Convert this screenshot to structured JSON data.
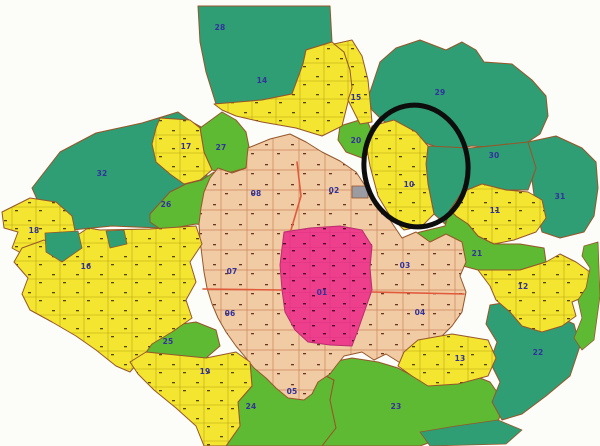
{
  "map": {
    "background": "#fcfcf9",
    "label_color": "#32329b",
    "road_color": "#e05a3c",
    "borders": {
      "default": "#96562a",
      "magenta": "#b72f6e"
    },
    "colors": {
      "teal": "#2f9e74",
      "green": "#5fba33",
      "yellow": "#f4e630",
      "salmon": "#f1cba4",
      "magenta": "#ee3f8d",
      "grey": "#9b9ba2",
      "salmon_line": "#c97d53",
      "yellow_line": "#b0960f",
      "magenta_line": "#d62f7c",
      "mark_salmon": "#6b3522",
      "mark_yellow": "#564508",
      "mark_magenta": "#55082e"
    },
    "annotation_circle": {
      "cx": 416,
      "cy": 166,
      "rx": 52,
      "ry": 61,
      "stroke": "#0d0d0d",
      "width": 5
    },
    "zones": [
      {
        "id": "32",
        "label": "32",
        "color": "teal",
        "lx": 102,
        "ly": 176,
        "points": "60,152 96,133 142,123 178,112 192,122 212,133 206,162 208,190 198,222 160,228 112,226 72,230 40,206 32,188 46,170"
      },
      {
        "id": "28",
        "label": "28",
        "color": "teal",
        "lx": 220,
        "ly": 30,
        "points": "198,6 330,6 332,42 306,50 303,64 292,94 262,100 216,104 206,72 200,42"
      },
      {
        "id": "29",
        "label": "29",
        "color": "teal",
        "lx": 440,
        "ly": 95,
        "points": "368,98 380,62 396,48 420,40 446,50 462,42 476,50 484,62 512,64 532,80 546,96 548,116 540,134 528,142 502,148 472,146 446,150 422,142 400,132 382,120 372,110"
      },
      {
        "id": "31",
        "label": "31",
        "color": "teal",
        "lx": 560,
        "ly": 199,
        "points": "528,142 556,136 582,148 596,162 598,188 594,216 584,232 560,238 542,232 536,210 532,180 536,168"
      },
      {
        "id": "30",
        "label": "30",
        "color": "teal",
        "lx": 494,
        "ly": 158,
        "points": "428,146 470,148 528,142 536,168 528,190 506,190 482,184 462,192 450,210 445,224 434,214 428,184 426,164"
      },
      {
        "id": "26",
        "label": "26",
        "color": "green",
        "lx": 166,
        "ly": 207,
        "points": "150,214 170,192 186,184 202,180 214,172 230,174 248,170 254,186 250,206 236,222 210,226 196,224 162,230 150,222"
      },
      {
        "id": "27",
        "label": "27",
        "color": "green",
        "lx": 221,
        "ly": 150,
        "points": "200,128 222,112 236,120 246,132 250,152 246,168 228,173 212,170 204,152"
      },
      {
        "id": "20",
        "label": "20",
        "color": "green",
        "lx": 356,
        "ly": 143,
        "points": "340,126 366,118 372,132 374,150 362,158 346,152 338,140"
      },
      {
        "id": "25",
        "label": "25",
        "color": "green",
        "lx": 168,
        "ly": 344,
        "points": "136,342 140,330 196,322 216,330 220,346 206,358 170,358 146,352"
      },
      {
        "id": "24",
        "label": "24",
        "color": "green",
        "lx": 251,
        "ly": 409,
        "points": "250,362 266,368 290,374 318,372 334,380 330,400 336,428 322,446 226,446 240,426 238,402 252,386"
      },
      {
        "id": "23",
        "label": "23",
        "color": "green",
        "lx": 396,
        "ly": 409,
        "points": "318,372 332,362 352,358 378,362 398,368 420,380 440,372 470,374 490,382 504,402 498,422 458,432 420,446 322,446 336,428 330,400 334,380"
      },
      {
        "id": "22",
        "label": "22",
        "color": "teal",
        "lx": 538,
        "ly": 355,
        "points": "486,324 490,305 522,300 548,312 574,324 580,346 570,376 546,396 522,414 502,420 492,402 500,382 490,362 497,342"
      },
      {
        "id": "21",
        "label": "21",
        "color": "green",
        "lx": 477,
        "ly": 256,
        "points": "398,240 420,232 445,226 450,210 456,216 468,224 478,236 494,244 520,244 544,248 546,262 520,270 478,270 448,262 424,254"
      },
      {
        "id": "ring",
        "label": null,
        "color": "salmon",
        "pattern": true,
        "points": "248,148 270,139 290,134 306,142 322,152 340,161 356,172 368,190 382,208 394,226 402,238 416,232 430,242 446,234 462,242 466,262 460,276 466,292 462,312 452,326 438,340 424,348 410,352 402,364 386,354 374,360 362,352 344,356 336,366 330,374 318,382 312,394 304,400 288,398 276,388 266,378 254,368 246,358 236,346 226,332 218,318 212,304 207,288 204,272 202,256 200,240 199,224 201,208 204,192 210,178 218,168 232,173 246,168"
      },
      {
        "id": "01",
        "label": "01",
        "color": "magenta",
        "pattern": true,
        "lx": 322,
        "ly": 295,
        "points": "284,232 310,228 340,226 362,230 372,246 370,268 372,290 365,310 358,330 352,346 330,345 308,342 295,330 285,312 282,290 280,265 282,248"
      },
      {
        "id": "14",
        "label": "14",
        "color": "yellow",
        "pattern": true,
        "lx": 262,
        "ly": 83,
        "points": "214,104 262,100 292,94 303,64 306,50 332,42 344,52 350,70 354,90 348,102 342,126 322,136 296,128 262,122 236,116 222,110"
      },
      {
        "id": "15",
        "label": "15",
        "color": "yellow",
        "pattern": true,
        "lx": 356,
        "ly": 100,
        "points": "334,44 352,40 362,56 368,80 370,100 372,122 360,124 348,100 352,88 350,70 344,52"
      },
      {
        "id": "17",
        "label": "17",
        "color": "yellow",
        "pattern": true,
        "lx": 186,
        "ly": 149,
        "points": "160,118 190,120 200,128 204,152 212,170 200,180 184,184 170,174 156,162 152,144 156,128"
      },
      {
        "id": "18",
        "label": "18",
        "color": "yellow",
        "pattern": true,
        "lx": 34,
        "ly": 233,
        "points": "2,212 30,198 56,202 72,216 76,236 60,252 30,258 12,248 18,232 4,228"
      },
      {
        "id": "16",
        "label": "16",
        "color": "yellow",
        "pattern": true,
        "lx": 86,
        "ly": 269,
        "points": "88,228 100,230 150,229 196,226 202,244 190,262 196,282 186,300 192,318 172,332 152,344 142,358 130,372 116,366 96,350 76,336 52,322 30,310 22,294 28,278 14,262 22,248 44,240 62,252 76,236"
      },
      {
        "id": "19",
        "label": "19",
        "color": "yellow",
        "pattern": true,
        "lx": 205,
        "ly": 374,
        "points": "130,362 146,352 206,358 236,352 250,362 252,386 238,402 240,426 226,446 204,446 196,426 176,408 154,390 138,374"
      },
      {
        "id": "13",
        "label": "13",
        "color": "yellow",
        "pattern": true,
        "lx": 460,
        "ly": 361,
        "points": "398,366 404,352 418,340 452,334 488,340 496,358 488,376 458,384 428,386 412,376"
      },
      {
        "id": "12",
        "label": "12",
        "color": "yellow",
        "pattern": true,
        "lx": 523,
        "ly": 289,
        "points": "478,270 520,270 546,262 560,254 576,262 590,272 586,296 572,302 576,316 562,326 542,332 522,326 510,312 496,300 490,286"
      },
      {
        "id": "11",
        "label": "11",
        "color": "yellow",
        "pattern": true,
        "lx": 495,
        "ly": 213,
        "points": "462,192 482,184 506,190 528,192 542,200 546,218 536,232 514,240 494,244 478,236 468,224 456,216 450,210"
      },
      {
        "id": "10",
        "label": "10",
        "color": "yellow",
        "pattern": true,
        "lx": 409,
        "ly": 187,
        "points": "372,126 394,120 416,132 428,146 426,164 428,184 434,214 422,226 404,230 390,216 378,196 370,166 366,144"
      },
      {
        "id": "02",
        "label": "02",
        "color": "salmon",
        "lx": 334,
        "ly": 193
      },
      {
        "id": "03",
        "label": "03",
        "color": "salmon",
        "lx": 405,
        "ly": 268
      },
      {
        "id": "04",
        "label": "04",
        "color": "salmon",
        "lx": 420,
        "ly": 315
      },
      {
        "id": "05",
        "label": "05",
        "color": "salmon",
        "lx": 292,
        "ly": 394
      },
      {
        "id": "06",
        "label": "06",
        "color": "salmon",
        "lx": 230,
        "ly": 316
      },
      {
        "id": "07",
        "label": "07",
        "color": "salmon",
        "lx": 232,
        "ly": 274
      },
      {
        "id": "08",
        "label": "08",
        "color": "salmon",
        "lx": 256,
        "ly": 196
      }
    ],
    "patches": [
      {
        "name": "lake-patch-west",
        "color": "teal",
        "points": "45,233 78,231 82,248 62,262 46,252"
      },
      {
        "name": "lake-patch-west-2",
        "color": "teal",
        "points": "106,231 124,230 127,244 110,248"
      },
      {
        "name": "south-teal-zone",
        "color": "teal",
        "points": "420,432 456,426 498,420 522,430 506,444 430,446"
      },
      {
        "name": "east-green-strip",
        "color": "green",
        "points": "584,246 598,242 600,296 594,340 582,350 574,338 582,318 578,300 586,288 590,268 582,256"
      },
      {
        "name": "monument-landmark",
        "color": "grey",
        "points": "352,186 368,186 368,198 352,198"
      }
    ],
    "roads": [
      "297,162 301,196 291,230",
      "203,289 281,290",
      "372,292 464,294"
    ]
  }
}
